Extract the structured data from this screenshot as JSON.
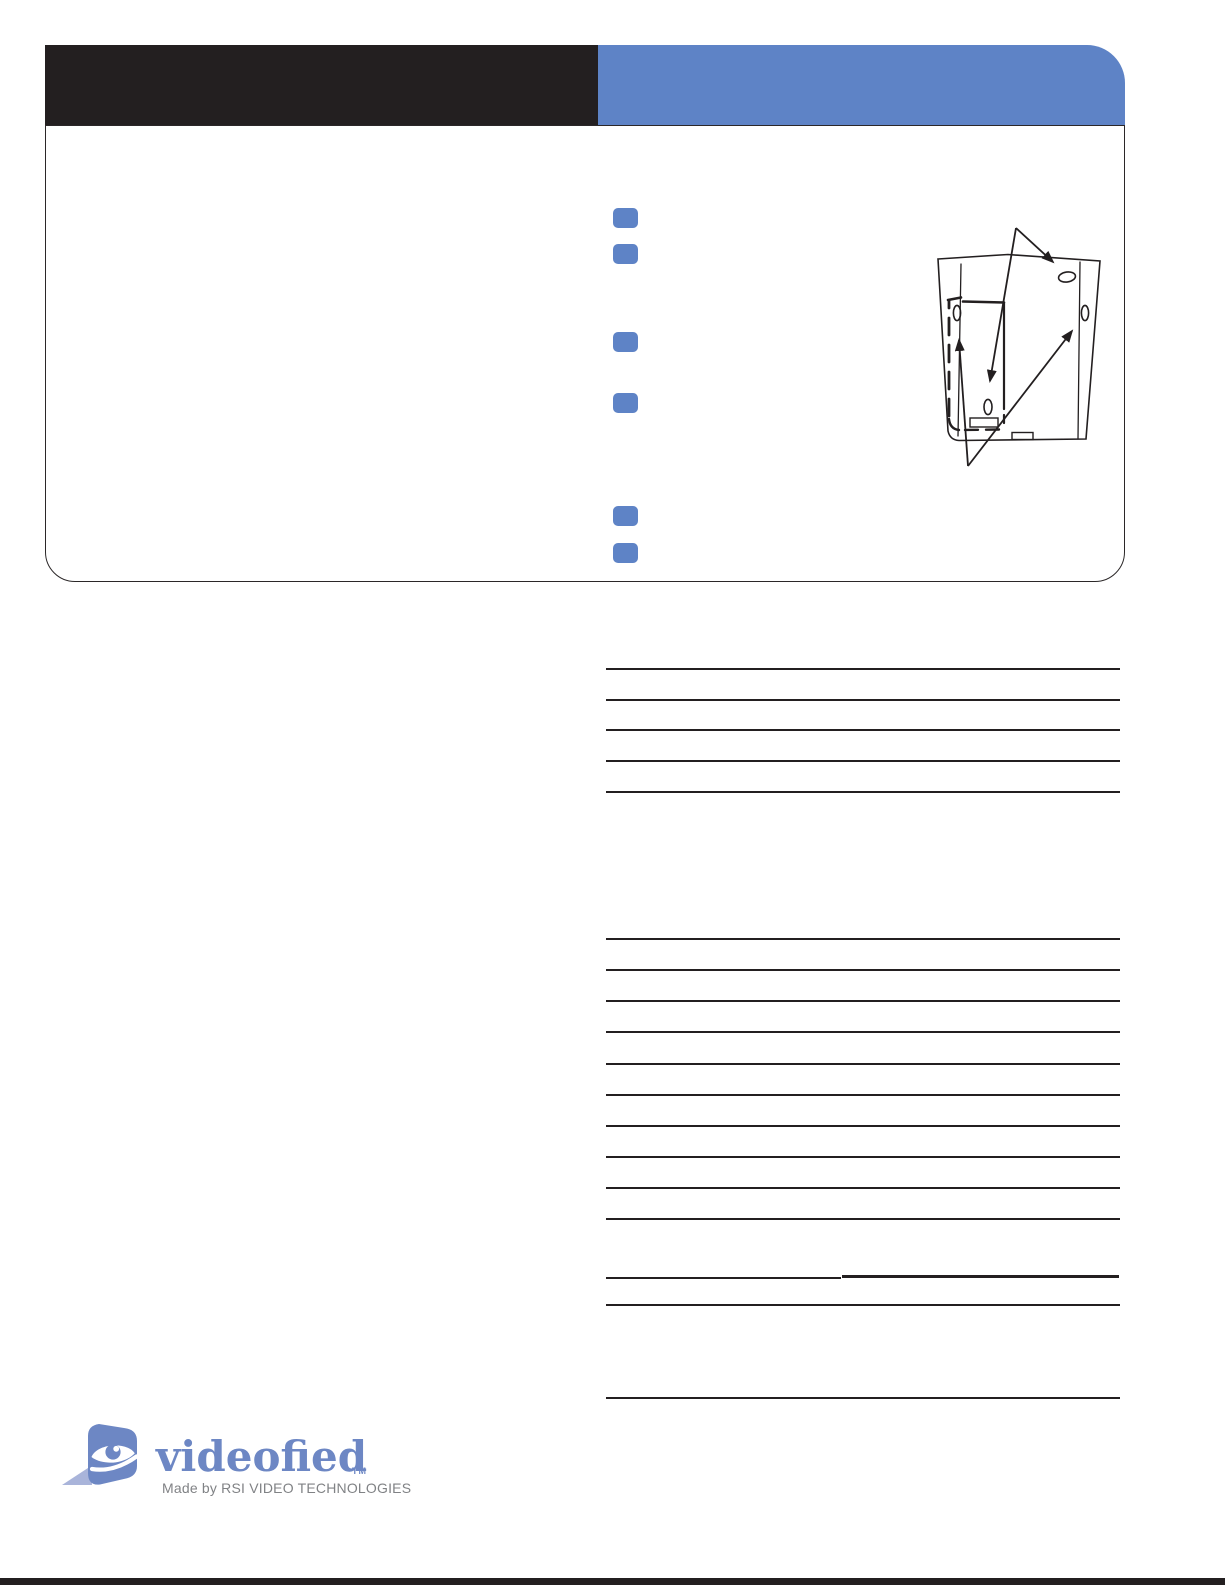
{
  "colors": {
    "ink_black": "#231f20",
    "accent_blue": "#5e83c6",
    "logo_blue": "#6d87c4",
    "logo_light_blue": "#a9b4da",
    "tagline_gray": "#808285",
    "panel_border": "#2b2728"
  },
  "checklist": {
    "marker_color": "#5e83c6",
    "marker_y_positions": [
      208,
      244,
      332,
      393,
      506,
      543
    ]
  },
  "spec_rules": {
    "x_start": 606,
    "x_end": 1120,
    "group_a_y": [
      668,
      699,
      729,
      760,
      791
    ],
    "group_b_y": [
      938,
      969,
      1000,
      1031,
      1063,
      1094,
      1125,
      1156,
      1187,
      1218
    ],
    "split_line": {
      "left": [
        606,
        1277,
        841
      ],
      "right": [
        842,
        1275,
        1119
      ]
    },
    "extra_y": [
      1304,
      1397
    ]
  },
  "logo": {
    "brand": "videofied",
    "trademark": "TM",
    "tagline": "Made by RSI VIDEO TECHNOLOGIES"
  }
}
